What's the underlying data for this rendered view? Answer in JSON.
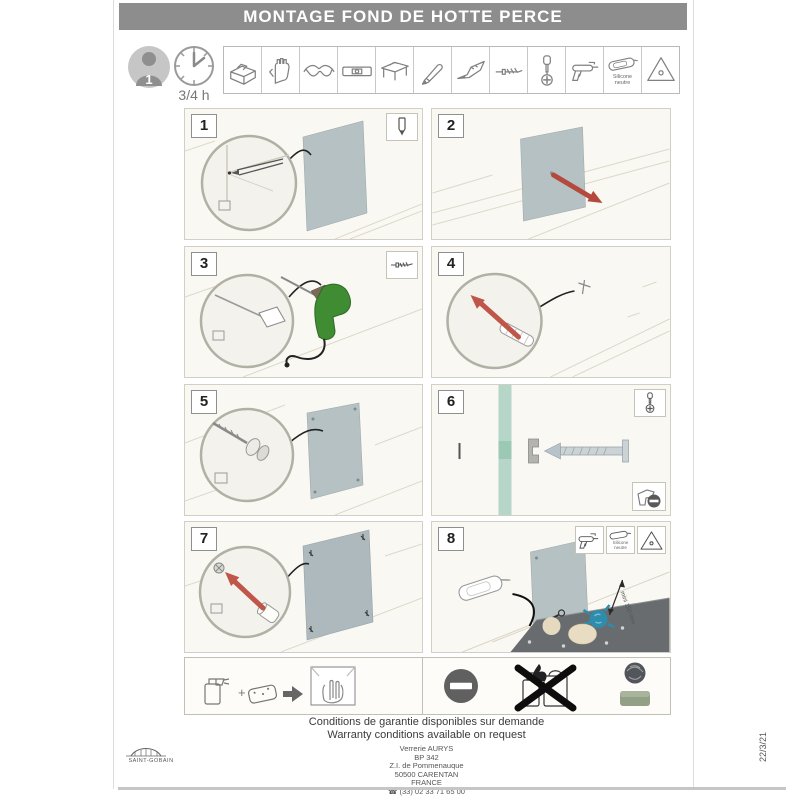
{
  "title": "MONTAGE FOND DE HOTTE PERCE",
  "header": {
    "persons": "1",
    "duration": "3/4 h",
    "tools": [
      "toolbox",
      "work gloves",
      "safety glasses",
      "spirit level",
      "workbench",
      "pencil",
      "utility knife",
      "drill bit",
      "phillips screwdriver",
      "caulking gun",
      "neutral silicone cartridge",
      "smoothing triangle"
    ],
    "silicone_line1": "Silicone",
    "silicone_line2": "neutre"
  },
  "steps": [
    {
      "number": "1",
      "badge": "pencil-icon"
    },
    {
      "number": "2"
    },
    {
      "number": "3",
      "badge": "drill-bit-icon"
    },
    {
      "number": "4"
    },
    {
      "number": "5"
    },
    {
      "number": "6",
      "badge": "screwdriver-icon",
      "corner_badge": "no-screw-gun-icon"
    },
    {
      "number": "7"
    },
    {
      "number": "8",
      "badges": [
        "caulking-gun-icon",
        "silicone-neutre-icon",
        "smoothing-triangle-icon"
      ],
      "dimension_label": "mini 150 mm"
    }
  ],
  "care": {
    "clean_icons": [
      "spray-cleaner-icon",
      "sponge-icon",
      "arrow-icon",
      "soft-wipe-icon"
    ],
    "avoid_icons": [
      "prohibition-icon",
      "no-solvents-flammables-icon",
      "steel-wool-icon",
      "abrasive-sponge-icon"
    ]
  },
  "footer": {
    "line1": "Conditions de garantie disponibles sur demande",
    "line2": "Warranty conditions available on request",
    "address": [
      "Verrerie AURYS",
      "BP 342",
      "Z.I. de Pommenauque",
      "50500 CARENTAN",
      "FRANCE"
    ],
    "phone": "(33) 02 33 71 65 00"
  },
  "brand": "SAINT-GOBAIN",
  "date_code": "22/3/21",
  "colors": {
    "banner": "#8d8d8d",
    "panel": "#b6c1c3",
    "arrow_red": "#b44a3e",
    "drill_green": "#3f8c33",
    "glass_teal": "#b5d6c9",
    "countertop": "#686c6f",
    "splash_blue": "#2e8cac"
  }
}
